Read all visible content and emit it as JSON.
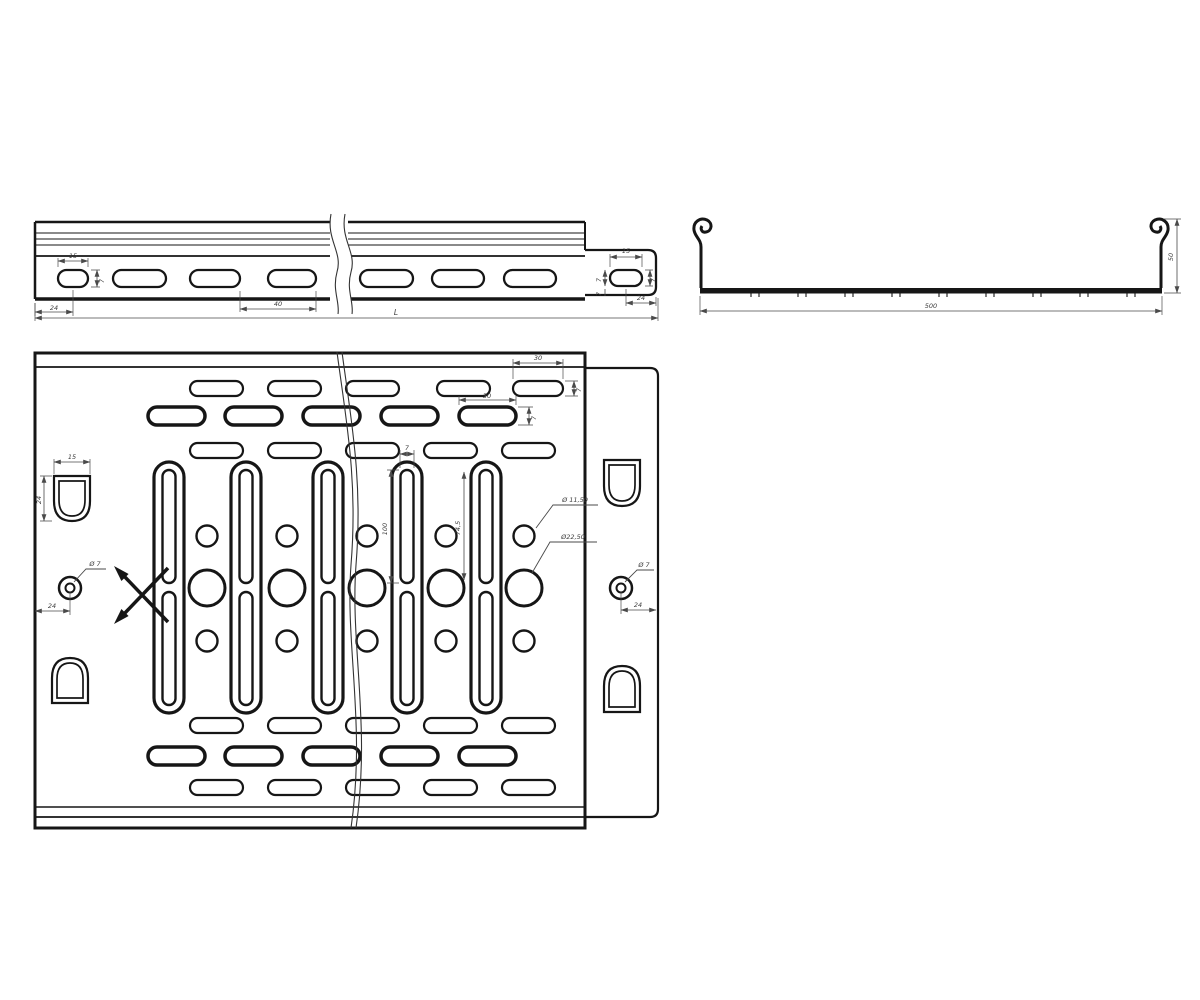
{
  "side_view": {
    "slot_width": "15",
    "slot_height": "7",
    "edge_offset": "24",
    "slot_pitch": "40",
    "total_length": "L",
    "tab_slot_width": "15",
    "tab_slot_height": "7",
    "tab_edge_offset": "24",
    "tab_web_upper": "7",
    "tab_web_lower": "7"
  },
  "section_view": {
    "width": "500",
    "height": "50"
  },
  "plan_view": {
    "row1_slot_width": "30",
    "row1_slot_height": "7",
    "row2_slot_width": "30",
    "row2_slot_height": "7",
    "vslot_width": "7",
    "vslot_length": "100",
    "vslot_spacing": "74,5",
    "small_hole_dia": "Ø 11,50",
    "large_hole_dia": "Ø22,50",
    "cutout_width": "15",
    "cutout_height": "24",
    "left_hole_dia": "Ø 7",
    "left_hole_offset": "24",
    "right_hole_dia": "Ø 7",
    "right_hole_offset": "24"
  }
}
